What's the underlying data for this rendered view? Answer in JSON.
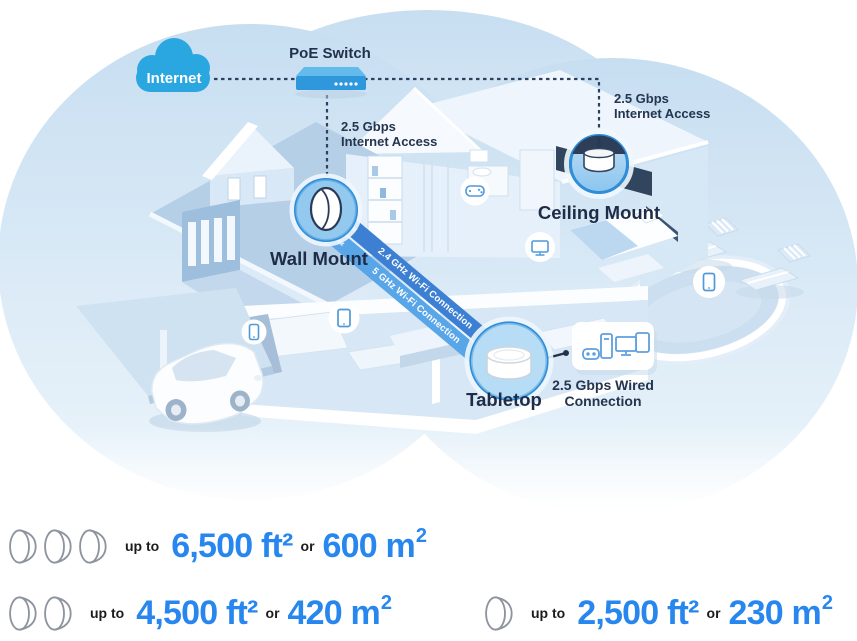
{
  "diagram": {
    "internet": {
      "label": "Internet"
    },
    "poe_switch": {
      "label": "PoE Switch"
    },
    "wall_mount": {
      "label": "Wall Mount",
      "access_line1": "2.5 Gbps",
      "access_line2": "Internet Access"
    },
    "ceiling_mount": {
      "label": "Ceiling Mount",
      "access_line1": "2.5 Gbps",
      "access_line2": "Internet Access"
    },
    "tabletop": {
      "label": "Tabletop",
      "wired_line1": "2.5 Gbps Wired",
      "wired_line2": "Connection"
    },
    "ribbon": {
      "band1_label": "2.4 GHz Wi-Fi Connection",
      "band2_label": "5 GHz Wi-Fi Connection",
      "arrows_left": "««",
      "arrows_right": "»»"
    },
    "device_icons": [
      "smartphone-icon",
      "tablet-icon",
      "gamepad-icon",
      "tv-icon",
      "smartphone-icon",
      "gamepad-icon",
      "desktop-tower-icon",
      "monitor-icon",
      "tablet-icon"
    ]
  },
  "coverage": {
    "rows": [
      {
        "device_count": 3,
        "prefix": "up to",
        "imperial": "6,500 ft²",
        "conjunction": "or",
        "metric_base": "600 m",
        "metric_sup": "2"
      },
      {
        "device_count": 2,
        "prefix": "up to",
        "imperial": "4,500 ft²",
        "conjunction": "or",
        "metric_base": "420 m",
        "metric_sup": "2"
      },
      {
        "device_count": 1,
        "prefix": "up to",
        "imperial": "2,500 ft²",
        "conjunction": "or",
        "metric_base": "230 m",
        "metric_sup": "2"
      }
    ]
  },
  "colors": {
    "accent_blue": "#2787EE",
    "internet_cloud_blue": "#2AA7E1",
    "ribbon_dark_blue": "#3D80D3",
    "ribbon_light_blue": "#58A5E7",
    "navy_text": "#1F2C47"
  }
}
